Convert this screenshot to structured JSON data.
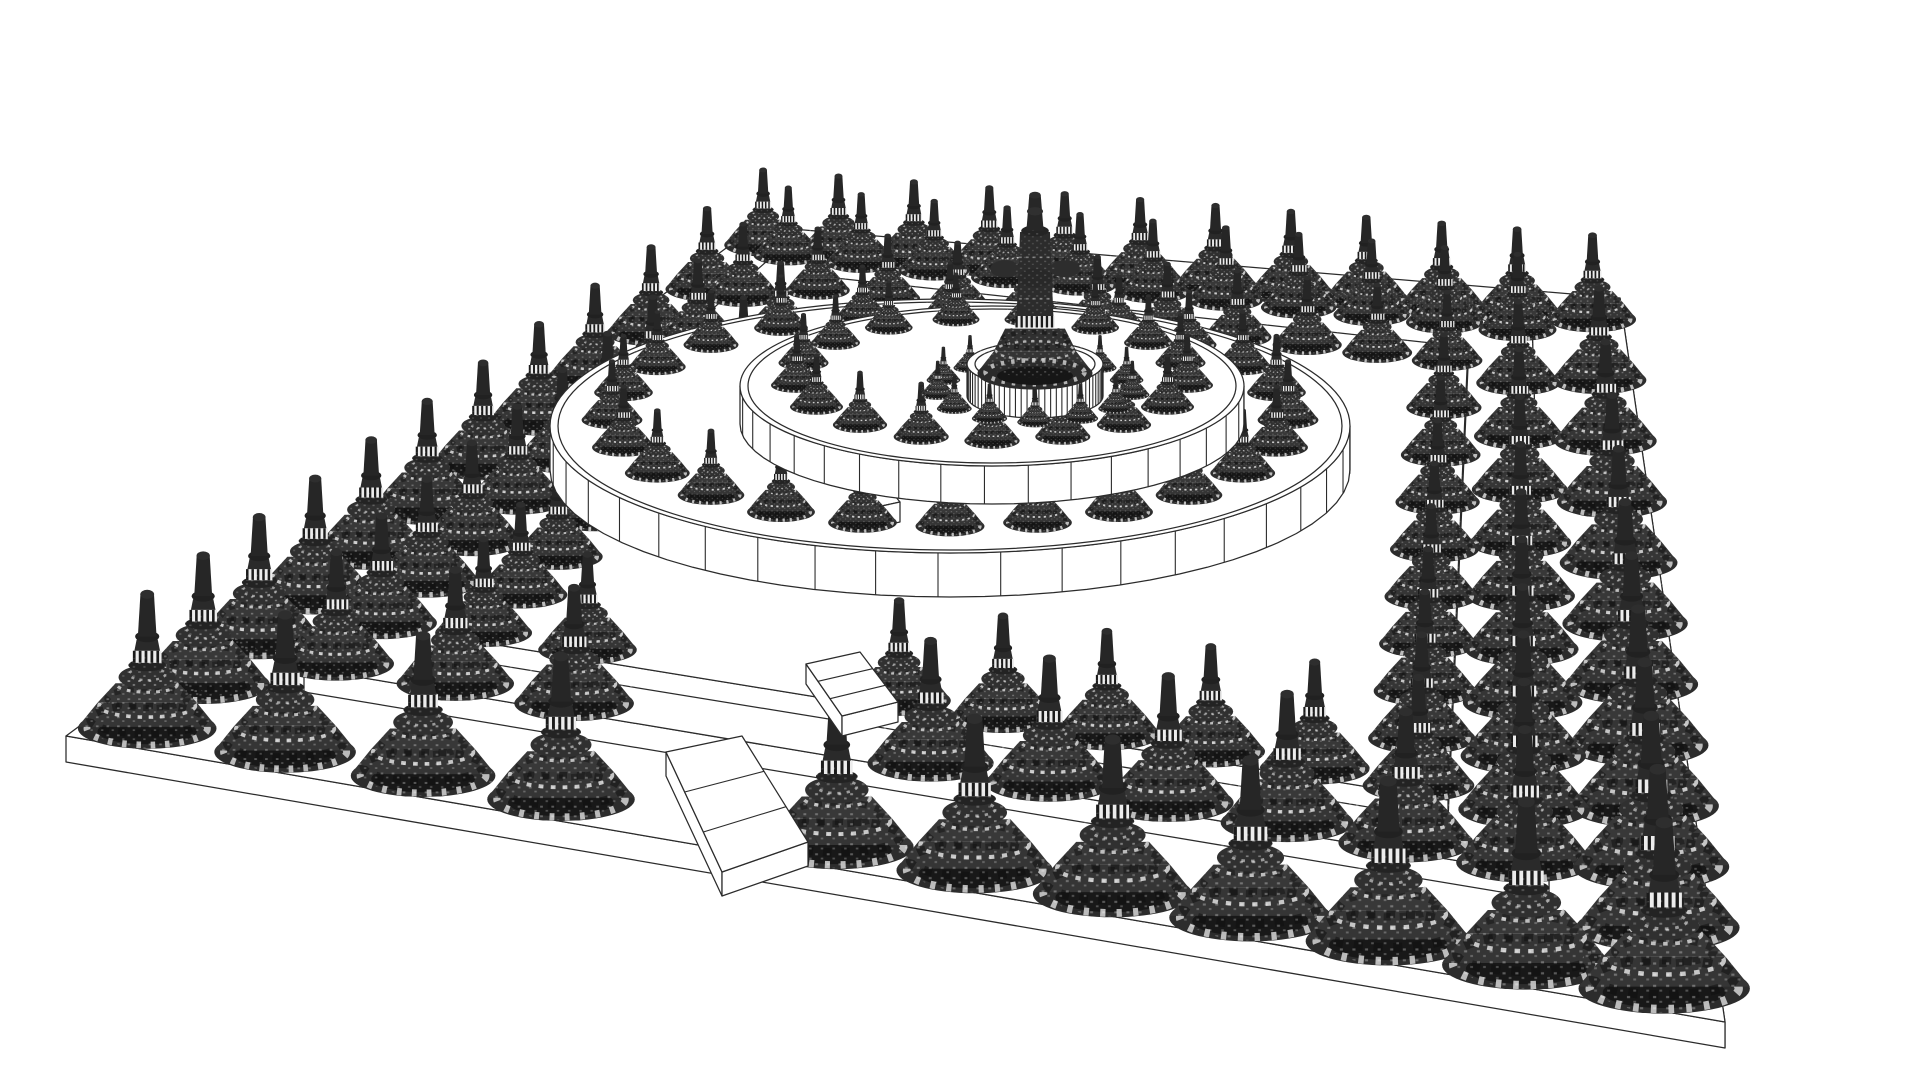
{
  "palette": {
    "background": "#ffffff",
    "line": "#2b2b2b",
    "fill_white": "#ffffff",
    "stupa_body": "#353535",
    "stupa_mid": "#383838",
    "stupa_dome": "#303030",
    "stupa_dark": "#181818",
    "stupa_rim": "#2c2c2c",
    "stupa_neck": "#2a2a2a",
    "stupa_spire": "#262626",
    "band_light": "#ececec",
    "band_stripe": "#1b1b1b",
    "highlight": "#d6d6d6",
    "rib_shadow": "#0d0d0d"
  },
  "canvas": {
    "width": 1920,
    "height": 1080
  },
  "scene": {
    "perspective": {
      "a": 0.5,
      "b": 0.00135,
      "min": 0.55,
      "max": 1.95
    },
    "near_threshold": 560,
    "base_quad": {
      "corners": [
        [
          66,
          736
        ],
        [
          756,
          226
        ],
        [
          1620,
          298
        ],
        [
          1725,
          1022
        ]
      ],
      "thickness": 26
    },
    "terraces": [
      {
        "name": "terrace-platform-1",
        "corners": [
          [
            304,
            668
          ],
          [
            783,
            247
          ],
          [
            1532,
            322
          ],
          [
            1549,
            876
          ]
        ],
        "thickness": 24
      },
      {
        "name": "terrace-platform-2",
        "corners": [
          [
            442,
            636
          ],
          [
            808,
            275
          ],
          [
            1468,
            347
          ],
          [
            1448,
            800
          ]
        ],
        "thickness": 20
      }
    ],
    "perimeter_rings": [
      {
        "name": "perimeter-ring-outer",
        "f": 0.93,
        "raise": 4,
        "size": 1.02,
        "n": 11,
        "front_gap": [
          0.3,
          0.44
        ]
      },
      {
        "name": "perimeter-ring-middle",
        "f": 0.76,
        "raise": 46,
        "size": 0.9,
        "n": 10,
        "front_gap": [
          0.3,
          0.44
        ]
      },
      {
        "name": "perimeter-ring-inner",
        "f": 0.62,
        "raise": 56,
        "size": 0.78,
        "n": 9,
        "front_gap": [
          0.31,
          0.43
        ]
      }
    ],
    "walls": [
      {
        "name": "outer-circular-wall",
        "cx": 950,
        "cy": 470,
        "rx": 400,
        "ry": 127,
        "h": 44,
        "post_deg": 9
      },
      {
        "name": "middle-circular-wall",
        "cx": 992,
        "cy": 424,
        "rx": 252,
        "ry": 80,
        "h": 38,
        "post_deg": 10
      },
      {
        "name": "inner-drum-wall",
        "cx": 1035,
        "cy": 396,
        "rx": 68,
        "ry": 22,
        "h": 32,
        "post_deg": 5
      }
    ],
    "circle_rings": [
      {
        "name": "outer-stupa-ring",
        "layer": 0,
        "cx": 950,
        "cy": 470,
        "rx": 338,
        "ry": 106,
        "raise": 52,
        "n": 24,
        "size": 0.62
      },
      {
        "name": "middle-stupa-ring",
        "layer": 1,
        "cx": 992,
        "cy": 424,
        "rx": 196,
        "ry": 61,
        "raise": 46,
        "n": 17,
        "size": 0.55
      },
      {
        "name": "inner-stupa-ring",
        "layer": 2,
        "cx": 1035,
        "cy": 398,
        "rx": 98,
        "ry": 31,
        "raise": 8,
        "n": 13,
        "size": 0.36
      }
    ],
    "tower": {
      "x": 1035,
      "y": 370,
      "scale": 1.15
    },
    "stairs": [
      {
        "name": "stairway-lower",
        "top": [
          [
            666,
            752
          ],
          [
            742,
            736
          ],
          [
            808,
            842
          ],
          [
            722,
            872
          ]
        ],
        "depth": 870,
        "thickness": 24,
        "steps": 2
      },
      {
        "name": "stairway-upper",
        "top": [
          [
            806,
            664
          ],
          [
            860,
            652
          ],
          [
            898,
            702
          ],
          [
            842,
            716
          ]
        ],
        "depth": 714,
        "thickness": 20,
        "steps": 2
      }
    ],
    "gate": {
      "top": [
        [
          858,
          496
        ],
        [
          890,
          490
        ],
        [
          900,
          502
        ],
        [
          868,
          509
        ]
      ],
      "front": [
        [
          868,
          509
        ],
        [
          900,
          502
        ],
        [
          900,
          522
        ],
        [
          868,
          529
        ]
      ],
      "depth": 520
    }
  }
}
